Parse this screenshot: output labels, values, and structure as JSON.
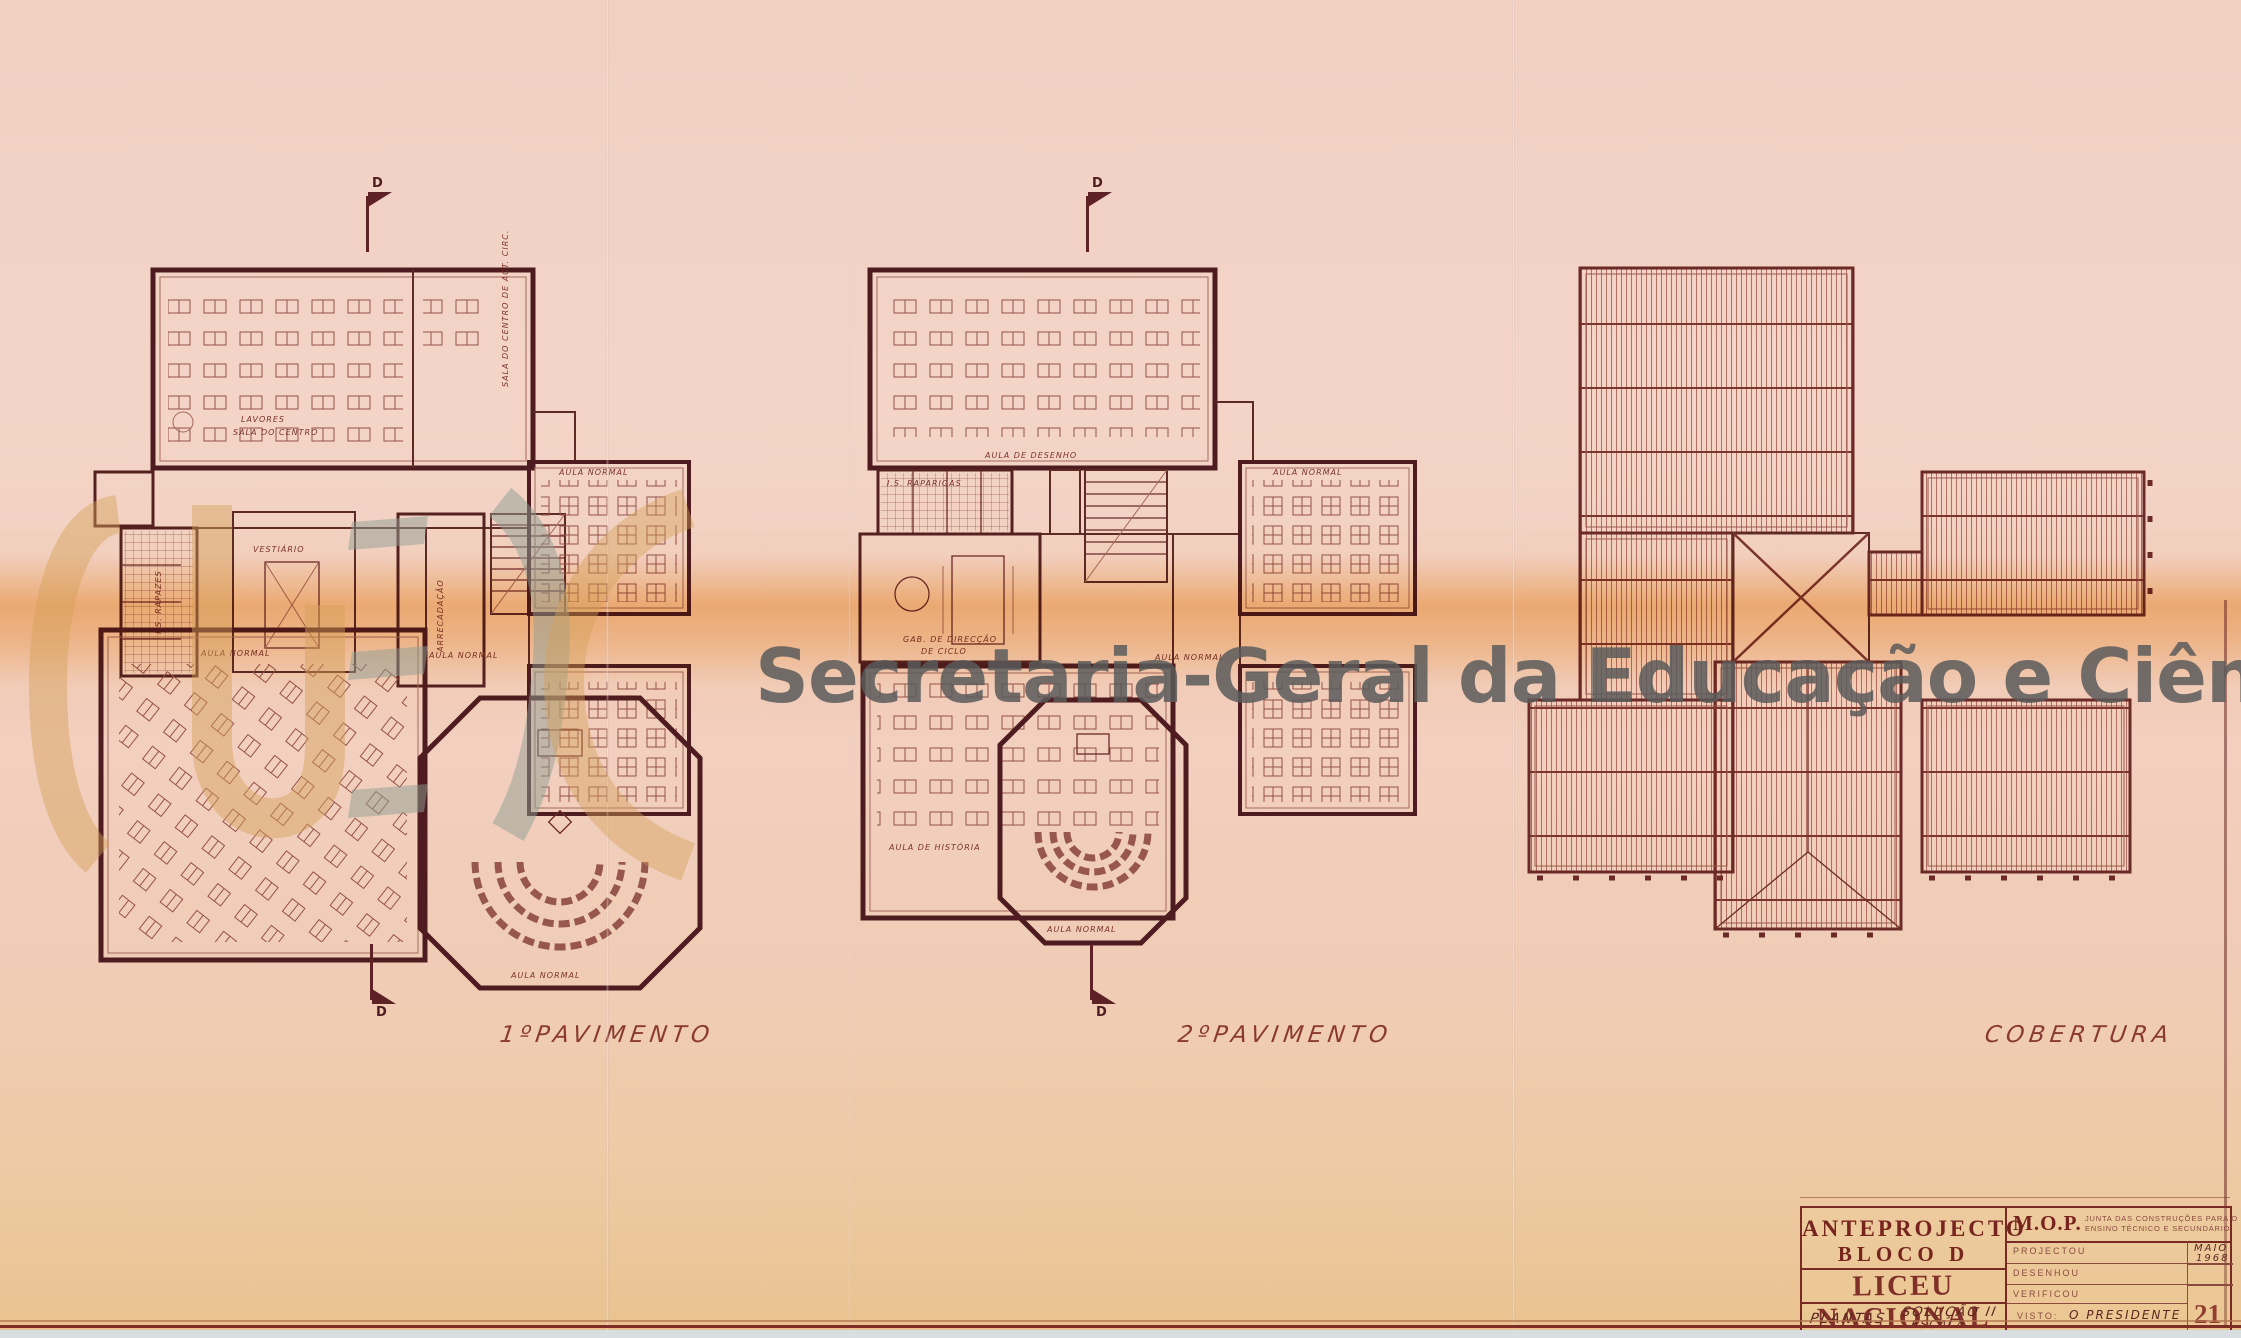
{
  "watermark": {
    "text": "Secretaria-Geral da Educação e Ciência"
  },
  "section_marker": {
    "letter": "D"
  },
  "plans": {
    "p1": {
      "caption": "1ºPAVIMENTO",
      "labels": {
        "lavores": "LAVORES",
        "sala_centro": "SALA DO CENTRO",
        "anexo": "SALA DO CENTRO DE ACT. CIRC.",
        "is_rapazes": "I.S. RAPAZES",
        "vestiario": "VESTIÁRIO",
        "arrecadacao": "ARRECADAÇÃO",
        "aula1": "AULA NORMAL",
        "aula2": "AULA NORMAL",
        "aula3": "AULA NORMAL",
        "aula4": "AULA NORMAL"
      }
    },
    "p2": {
      "caption": "2ºPAVIMENTO",
      "labels": {
        "desenho": "AULA DE DESENHO",
        "is_raparigas": "I.S. RAPARIGAS",
        "gab1": "GAB. DE DIRECÇÃO",
        "gab2": "DE CICLO",
        "aula1": "AULA NORMAL",
        "aula2": "AULA NORMAL",
        "historia": "AULA DE HISTÓRIA",
        "aula3": "AULA NORMAL"
      }
    },
    "p3": {
      "caption": "COBERTURA"
    }
  },
  "title_block": {
    "project_title_1": "ANTEPROJECTO",
    "project_title_2": "BLOCO D",
    "stamp": "LICEU NACIONAL",
    "drawing_type": "PLANTAS",
    "solution": "SOLUÇÃO II",
    "scale": "ESCALA 1:100",
    "org_abbr": "M.O.P.",
    "org_line1": "JUNTA DAS CONSTRUÇÕES PARA O",
    "org_line2": "ENSINO TÉCNICO E SECUNDÁRIO",
    "row_projectou": "PROJECTOU",
    "row_desenhou": "DESENHOU",
    "row_verificou": "VERIFICOU",
    "date_month": "MAIO",
    "date_year": "1968",
    "visto": "VISTO:",
    "president": "O PRESIDENTE",
    "sheet": "21"
  },
  "colors": {
    "paper": "#f2d0c1",
    "ink": "#4e1c20",
    "band": "#f2ac46",
    "watermark_text": "#5a5a5a",
    "logo_tan": "#d5a058",
    "logo_sage": "#8f9e93",
    "stamp_red": "#77241f"
  }
}
